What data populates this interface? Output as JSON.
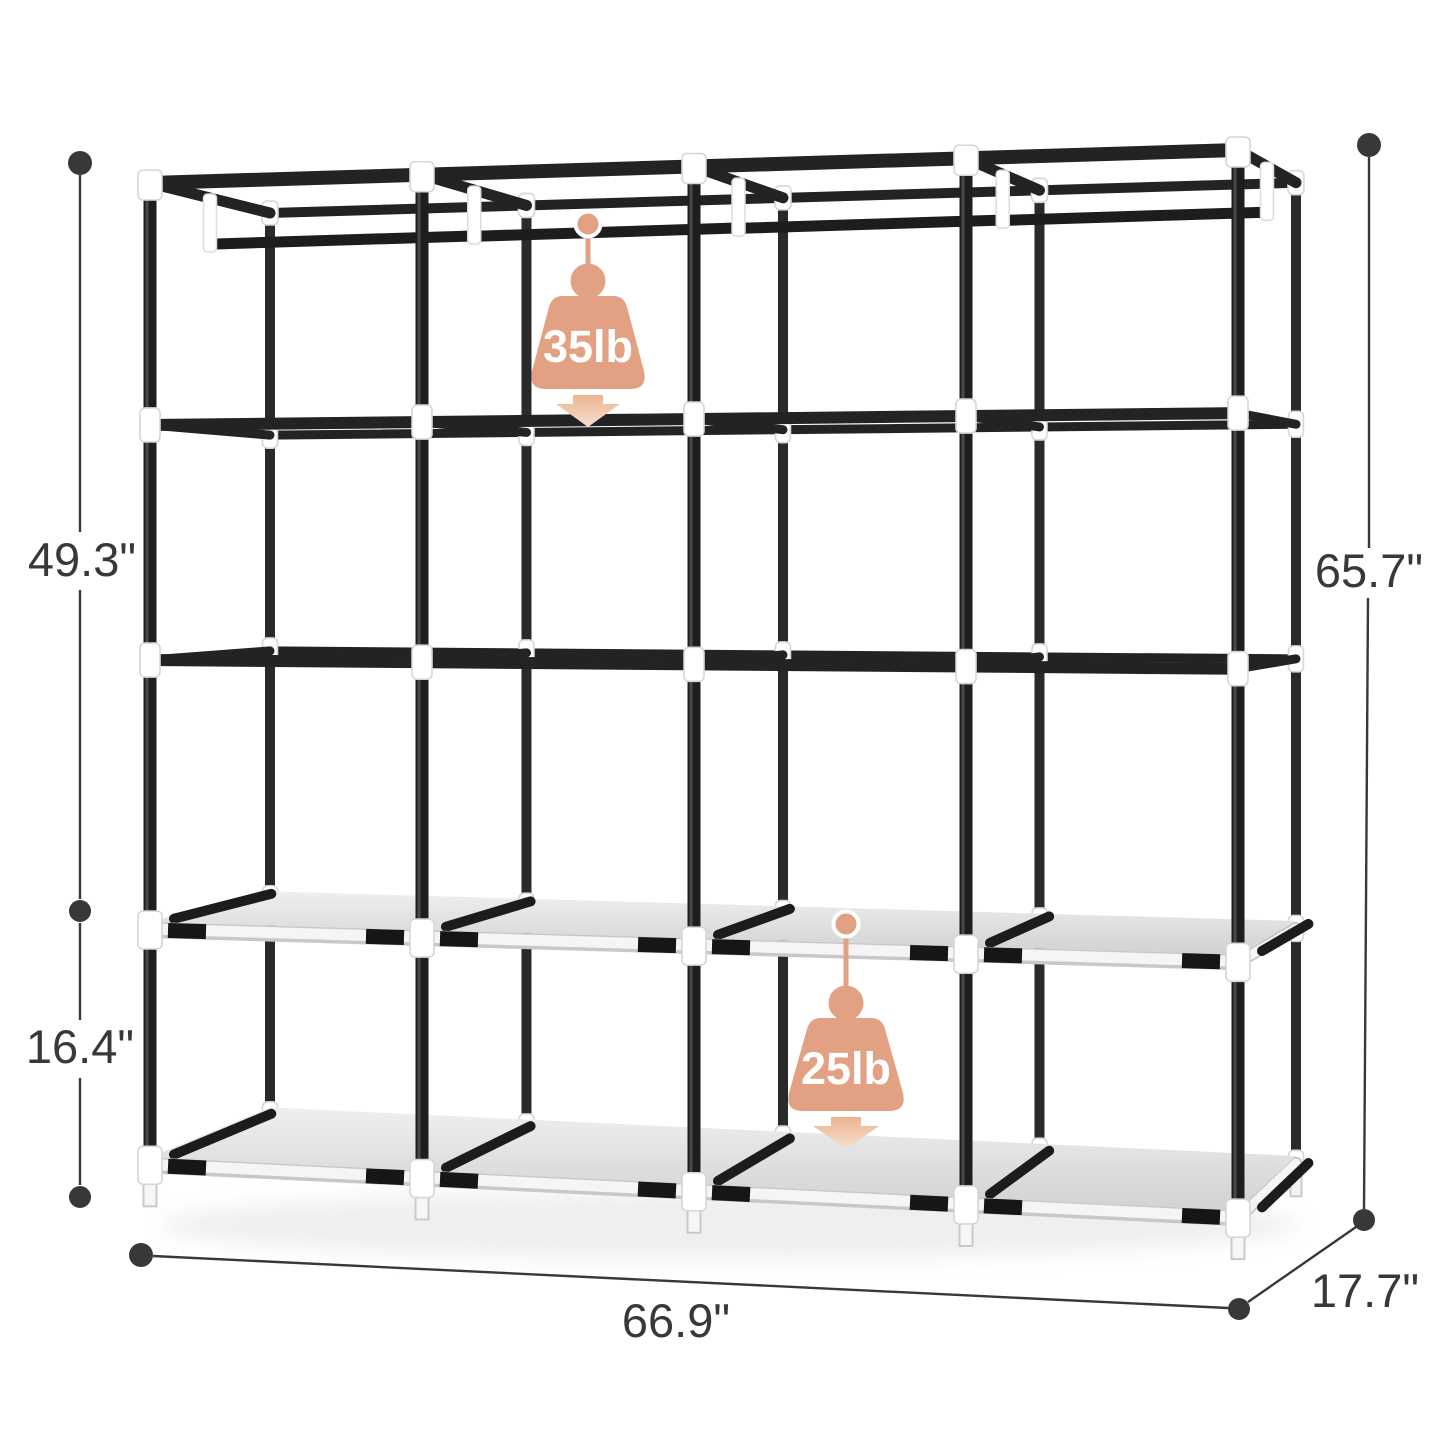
{
  "dimensions": {
    "upper_height": "49.3\"",
    "lower_height": "16.4\"",
    "total_height": "65.7\"",
    "width": "66.9\"",
    "depth": "17.7\""
  },
  "capacities": {
    "hanging_rod": "35lb",
    "shelf": "25lb"
  },
  "colors": {
    "accent": "#E2A182",
    "accent_light": "#F6DFCE",
    "frame_black": "#232323",
    "pole_black": "#1e1e1e",
    "connector_white": "#FFFFFF",
    "shelf_gray": "#DEDEDE",
    "dimension_text": "#383838",
    "background": "#FFFFFF"
  }
}
